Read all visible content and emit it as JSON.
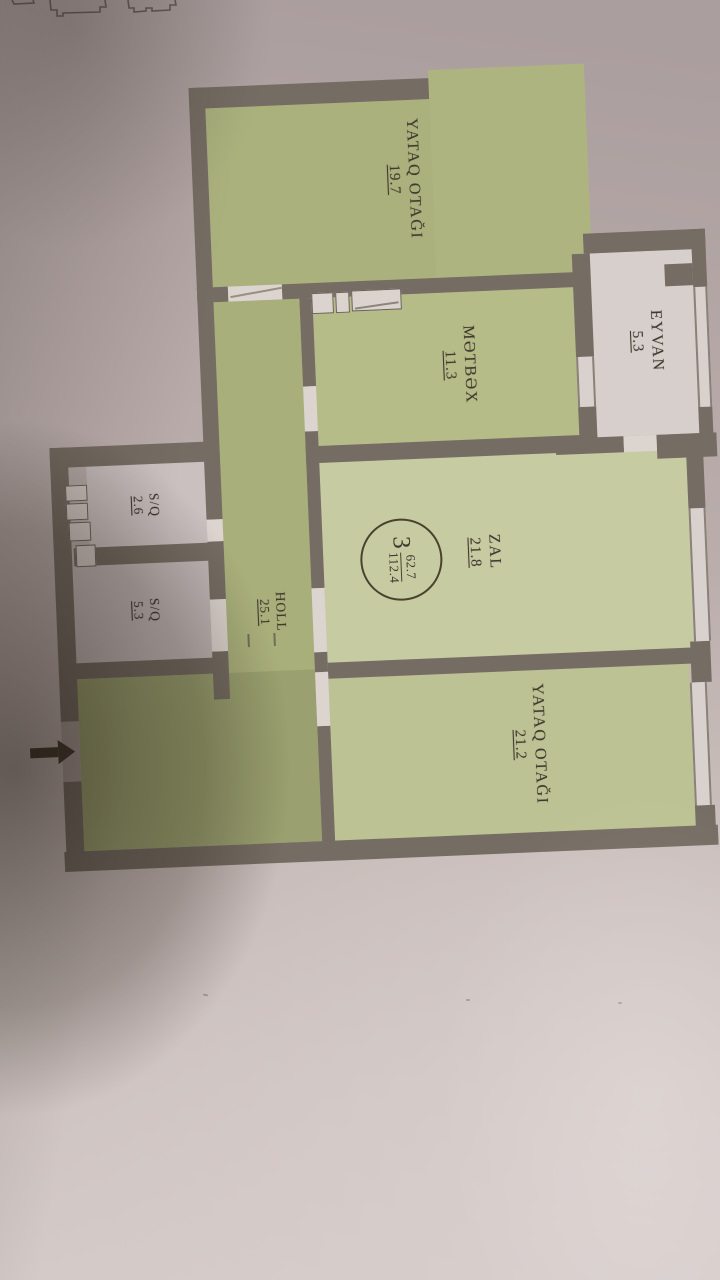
{
  "plan": {
    "title": "apartment-floor-plan",
    "rooms": [
      {
        "id": "bedroom-top",
        "label": "YATAQ OTAĞI",
        "area": "19.7"
      },
      {
        "id": "balcony",
        "label": "EYVAN",
        "area": "5.3"
      },
      {
        "id": "kitchen",
        "label": "MƏTBƏX",
        "area": "11.3"
      },
      {
        "id": "living-room",
        "label": "ZAL",
        "area": "21.8"
      },
      {
        "id": "hall",
        "label": "HOLL",
        "area": "25.1"
      },
      {
        "id": "sanitary-small",
        "label": "S/Q",
        "area": "2.6"
      },
      {
        "id": "sanitary-large",
        "label": "S/Q",
        "area": "5.3"
      },
      {
        "id": "bedroom-bottom",
        "label": "YATAQ OTAĞI",
        "area": "21.2"
      }
    ],
    "badge": {
      "rooms_count": "3",
      "living_area": "62.7",
      "total_area": "112.4"
    },
    "colors": {
      "room_fill": "#b8be8e",
      "wall": "#756c63",
      "white_room": "#d7cfcb",
      "text": "#3f392f",
      "background": "#c0b3b0"
    }
  }
}
